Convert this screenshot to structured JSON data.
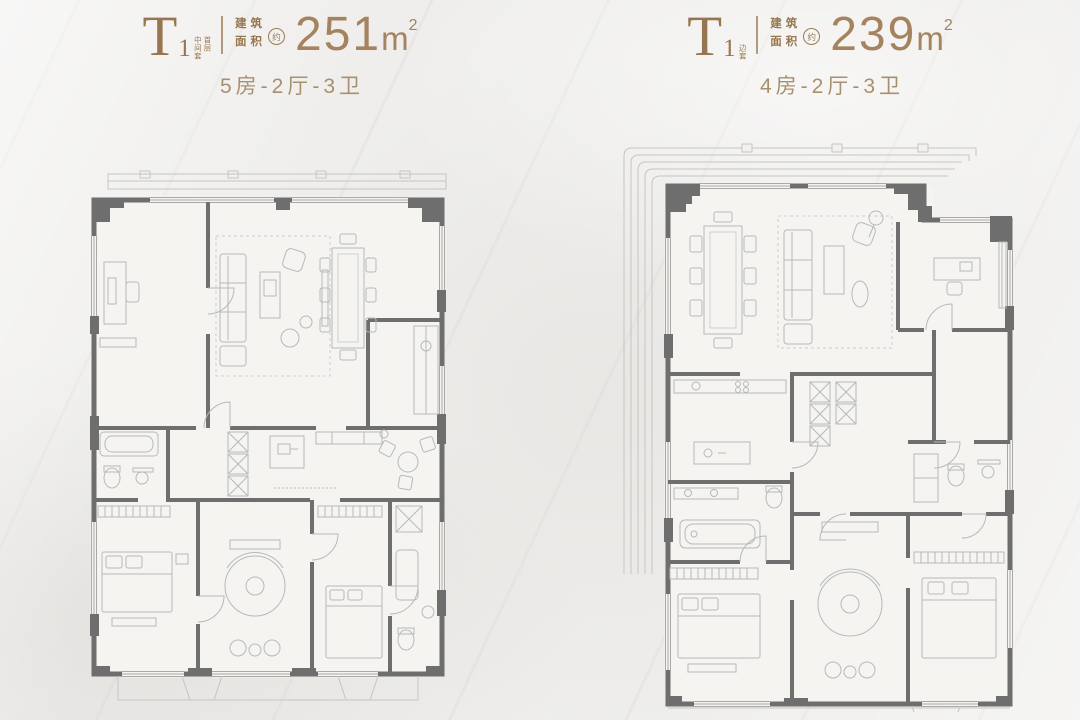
{
  "poster": {
    "background": "#efeeec",
    "colors": {
      "accent_brown": "#96764e",
      "number_bronze": "#a5835f",
      "config_tan": "#a8906f",
      "wall_gray": "#6e6e6e",
      "furniture_gray": "#b6b9ba"
    }
  },
  "units": [
    {
      "type_letter": "T",
      "type_number": "1",
      "tag_col1": "中间套",
      "tag_col2": "首层",
      "area_label_line1": "建筑",
      "area_label_line2": "面积",
      "approx_mark": "约",
      "area_value": "251",
      "area_unit_base": "m",
      "area_unit_sup": "2",
      "layout_config": "5房-2厅-3卫"
    },
    {
      "type_letter": "T",
      "type_number": "1",
      "tag_col1": "边套",
      "tag_col2": "",
      "area_label_line1": "建筑",
      "area_label_line2": "面积",
      "approx_mark": "约",
      "area_value": "239",
      "area_unit_base": "m",
      "area_unit_sup": "2",
      "layout_config": "4房-2厅-3卫"
    }
  ]
}
